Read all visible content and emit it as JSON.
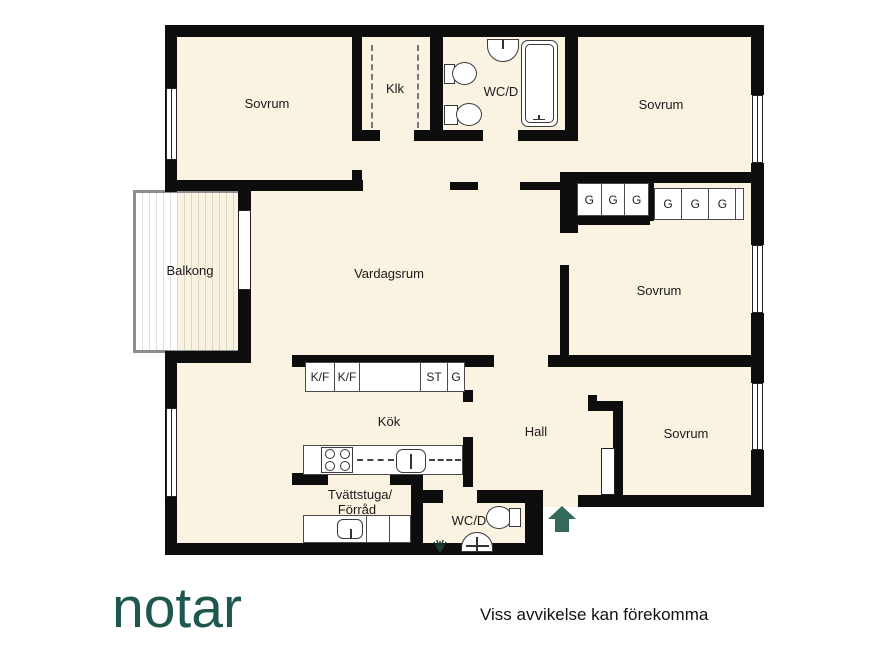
{
  "brand": {
    "logo_text": "notar"
  },
  "footer": {
    "disclaimer": "Viss avvikelse kan förekomma"
  },
  "plan": {
    "rooms": {
      "sovrum_tl": "Sovrum",
      "klk": "Klk",
      "wcd_top": "WC/D",
      "sovrum_tr": "Sovrum",
      "balkong": "Balkong",
      "vardagsrum": "Vardagsrum",
      "sovrum_mid": "Sovrum",
      "kok": "Kök",
      "hall": "Hall",
      "sovrum_br": "Sovrum",
      "tvattstuga_line1": "Tvättstuga/",
      "tvattstuga_line2": "Förråd",
      "wcd_bottom": "WC/D"
    },
    "closets": {
      "top_row_a": [
        "G",
        "G",
        "G"
      ],
      "top_row_b": [
        "G",
        "G",
        "G"
      ],
      "kitchen_row": [
        "K/F",
        "K/F",
        "",
        "ST",
        "G"
      ]
    },
    "colors": {
      "floor": "#FAF3E2",
      "wall": "#0D0D0D",
      "balcony": "#D5CCB9",
      "arrow": "#35695B",
      "brand": "#1D574D"
    }
  }
}
